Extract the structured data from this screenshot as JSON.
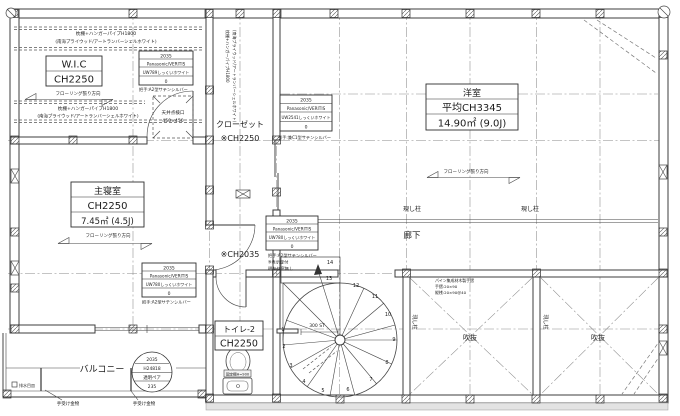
{
  "plan": {
    "rooms": {
      "wic": {
        "name": "W.I.C",
        "ch": "CH2250"
      },
      "master": {
        "name": "主寝室",
        "ch": "CH2250",
        "area": "7.45㎡ (4.5J)"
      },
      "closet": {
        "name": "クローゼット",
        "ch": "※CH2250"
      },
      "western": {
        "name": "洋室",
        "ch": "平均CH3345",
        "area": "14.90㎡ (9.0J)"
      },
      "hall": {
        "name": "廊下",
        "ch": "※CH2035"
      },
      "toilet": {
        "name": "トイレ-2",
        "ch": "CH2250"
      },
      "balcony": {
        "name": "バルコニー"
      },
      "void": {
        "name": "吹抜"
      }
    },
    "labels": {
      "exposed_column": "現し柱"
    },
    "notes": {
      "shelf1": "枕棚+ハンガーパイプH1800",
      "shelf2": "(南海プライウッド/アートランバーシェルホワイト)",
      "flooring": "フローリング張り方向",
      "hatch1": "天井点検口",
      "hatch2": "450×450",
      "rail1": "パイン集成材木製手摺",
      "rail2": "手摺:20×90",
      "rail3": "縦桟:20×90@40",
      "bracket": "手受け金物",
      "drain": "排水目皿",
      "shelf_fixed": "固定棚H=900",
      "stair_dim": "300 ST"
    },
    "specs": {
      "wic_door": {
        "size": "2035",
        "maker": "Panasonic/VERITIS",
        "model": "UW789しっくいホワイト",
        "qty": "0",
        "note1": "把手:A2型サテンシルバー"
      },
      "closet_door": {
        "size": "2035",
        "maker": "Panasonic/VERITIS",
        "model": "UW2541しっくいホワイト",
        "qty": "0",
        "note1": "引手:兼C1型サテンシルバー"
      },
      "hall_door": {
        "size": "2035",
        "maker": "Panasonic/VERITIS",
        "model": "UW780しっくいホワイト",
        "qty": "0",
        "note1": "把手:A2型サテンシルバー",
        "note2": "※表示錠付",
        "note3": "明かり窓無し"
      },
      "bedroom_door": {
        "size": "2035",
        "maker": "Panasonic/VERITIS",
        "model": "UW780しっくいホワイト",
        "qty": "0",
        "note1": "把手:A2型サテンシルバー"
      },
      "balcony_window": {
        "size": "2035",
        "model": "H24818",
        "glass": "透明ペア",
        "num": "235"
      }
    },
    "stair": {
      "numbers": [
        "1",
        "2",
        "3",
        "4",
        "5",
        "6",
        "7",
        "8",
        "9",
        "10",
        "11",
        "12",
        "13",
        "14"
      ]
    }
  }
}
